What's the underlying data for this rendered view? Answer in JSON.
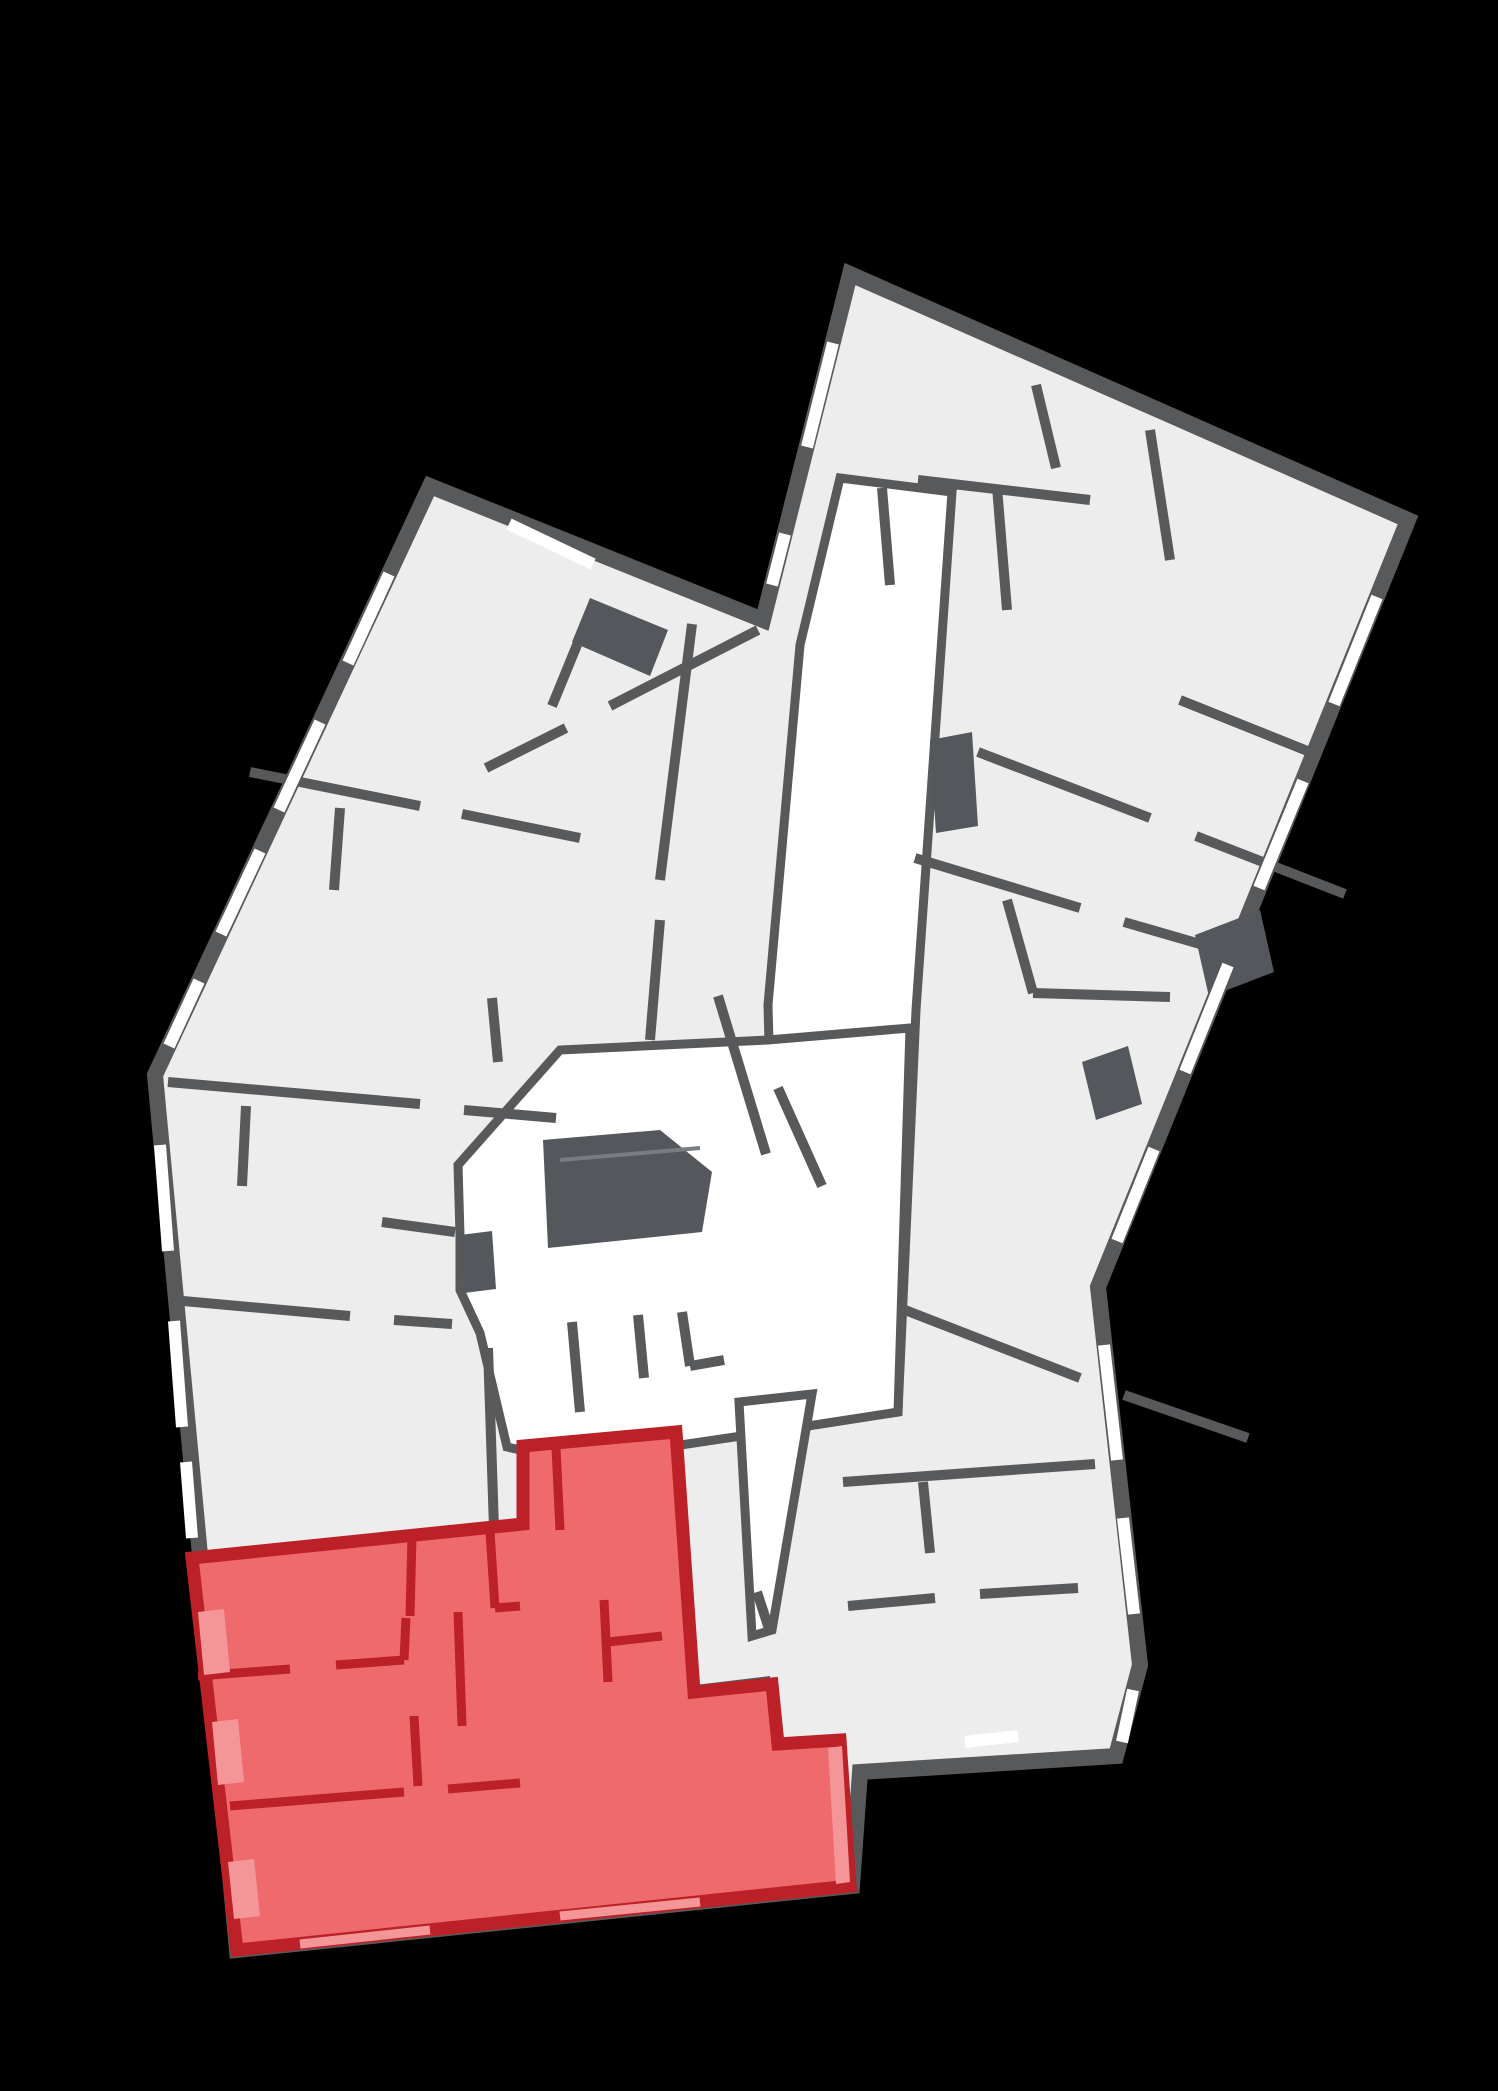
{
  "scene": {
    "kind": "residential floor plan",
    "highlight": "apartment unit highlighted in red at lower left"
  },
  "palette": {
    "background": "#000000",
    "floor": "#ededee",
    "wall": "#58595b",
    "corridor": "#ffffff",
    "core": "#54585c",
    "core_light": "#767c80",
    "window": "#ffffff",
    "unit_fill": "#ef6a6c",
    "unit_wall": "#bc2127",
    "unit_window": "#f49597"
  },
  "shapes": {
    "silhouette": "430,486 763,620 850,274 1408,520 1098,1287 1140,1665 1116,1756 860,1772 852,1886 237,1950 155,1075",
    "corridor_band": "840,478 952,492 916,1010 898,1412 795,1428 772,1160 768,1005 800,645",
    "corridor_hall": "458,1165 560,1050 768,1040 910,1028 898,1412 795,1428 674,1446 556,1458 507,1447 480,1333 460,1290 460,1235",
    "corridor_south": "739,1402 812,1394 772,1630 752,1636",
    "interior_walls": "M 250,772 L 420,806 M 462,814 L 580,838 M 168,1082 L 420,1104 M 464,1110 L 556,1118 M 172,1300 L 350,1316 M 394,1320 L 452,1324 M 382,1222 L 455,1232 M 488,1348 L 494,1528 M 340,808 L 334,890 M 246,1106 L 242,1186 M 588,618 L 552,706 M 758,630 L 610,706 M 566,728 L 486,768 M 692,624 L 660,880 M 660,920 L 650,1040 M 918,480 L 1090,500 M 882,488 L 890,585 M 997,487 L 1007,610 M 1036,385 L 1056,468 M 1150,430 L 1170,560 M 978,752 L 1150,818 M 1196,836 L 1345,894 M 915,858 L 1080,908 M 1124,922 L 1262,962 M 905,1310 L 1080,1378 M 1124,1395 L 1248,1438 M 718,996 L 766,1154 M 778,1088 L 822,1186 M 1007,900 L 1033,993 M 1033,993 L 1170,997 M 1180,700 L 1310,752 M 572,1322 L 580,1412 M 638,1315 L 644,1378 M 682,1312 L 690,1366 M 690,1366 L 724,1360 M 492,998 L 498,1062 M 843,1482 L 1095,1464 M 923,1482 L 930,1553 M 848,1606 L 935,1598 M 980,1594 L 1078,1588 M 757,1592 L 770,1632",
    "core_main": "543,1140 660,1130 712,1172 702,1232 548,1248",
    "shaft_a": "930,740 972,732 978,826 936,833",
    "shaft_b": "460,1235 492,1231 496,1289 464,1293",
    "balcony_notch": "590,598 668,630 650,676 572,642",
    "balcony_right_a": "1195,935 1260,910 1274,972 1209,997",
    "balcony_right_b": "1082,1062 1128,1046 1142,1104 1096,1120",
    "strip_bottom": "604,1696 770,1676 776,1748 610,1770",
    "core_details": "M 660,1690 L 664,1762 M 716,1684 L 720,1756 M 560,1160 L 700,1148",
    "windows": "M 389,574 L 348,663 M 320,722 L 279,810 M 260,851 L 221,934 M 199,981 L 169,1046 M 160,1145 L 168,1251 M 174,1321 L 182,1427 M 186,1462 L 192,1538 M 509,524 L 593,564 M 772,585 L 785,534 M 807,447 L 833,343 M 1377,597 L 1334,704 M 1303,781 L 1259,888 M 1228,965 L 1185,1072 M 1154,1149 L 1117,1241 M 1104,1345 L 1117,1460 M 1123,1518 L 1134,1614 M 1133,1690 L 1122,1742 M 965,1742 L 1018,1736",
    "unit_outline": "192,1558 523,1524 523,1446 676,1432 694,1692 772,1684 778,1744 840,1740 850,1886 237,1950",
    "unit_walls": "M 412,1536 L 410,1616 M 198,1676 L 290,1669 M 336,1665 L 404,1660 M 404,1660 L 406,1618 M 414,1716 L 418,1786 M 230,1806 L 404,1792 M 448,1789 L 520,1783 M 490,1532 L 495,1608 M 495,1608 L 520,1606 M 458,1612 L 462,1726 M 556,1448 L 560,1530 M 604,1600 L 608,1682 M 608,1642 L 662,1636",
    "unit_loggia_a": "198,1612 224,1609 230,1672 204,1675",
    "unit_loggia_b": "212,1722 238,1719 244,1782 218,1785",
    "unit_loggia_c": "228,1862 254,1859 260,1916 234,1919",
    "unit_balcony_band": "828,1748 842,1746 850,1882 836,1884",
    "unit_windows": "M 300,1944 L 430,1930 M 560,1916 L 700,1902"
  }
}
